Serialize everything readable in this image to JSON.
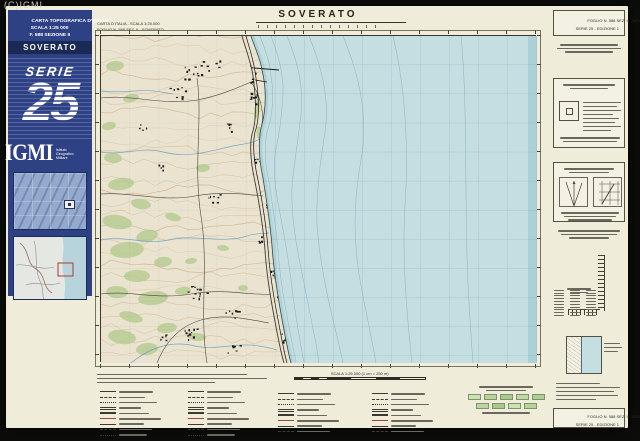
{
  "watermark": "(C)IGMI",
  "cover": {
    "title_line1": "CARTA TOPOGRAFICA D'ITALIA",
    "title_line2": "SCALA 1:25 000",
    "title_line3": "F. 588 SEZIONE II",
    "sheet_name": "SOVERATO",
    "series_word": "SERIE",
    "series_number": "25",
    "publisher": "IGMI",
    "publisher_line1": "Istituto",
    "publisher_line2": "Geografico",
    "publisher_line3": "Militare"
  },
  "map_header": {
    "corner_line1": "CARTA D'ITALIA - SCALA 1:25.000",
    "corner_line2": "FOGLIO N. 588 SEZ. II - SOVERATO",
    "title": "SOVERATO"
  },
  "right_margin": {
    "top_box_line1": "FOGLIO N. 588 SEZ. II - SOVERATO",
    "top_box_line2": "SERIE 25 - EDIZIONE 1",
    "bottom_box_line1": "FOGLIO N. 588 SEZ. II - SOVERATO",
    "bottom_box_line2": "SERIE 25 - EDIZIONE 1"
  },
  "legend": {
    "scale_label": "SCALA 1:25.000 (1 cm = 250 m)"
  },
  "colors": {
    "cover_blue": "#2e4184",
    "cover_dark": "#1b2a55",
    "sheet": "#efecda",
    "sea": "#c5dee1",
    "land": "#e9e3cf",
    "vegetation": "#b4cb90",
    "contour": "#c79d72",
    "grid_sea": "#5f93a8",
    "grid_land": "#8a8576",
    "ink": "#33302a"
  }
}
